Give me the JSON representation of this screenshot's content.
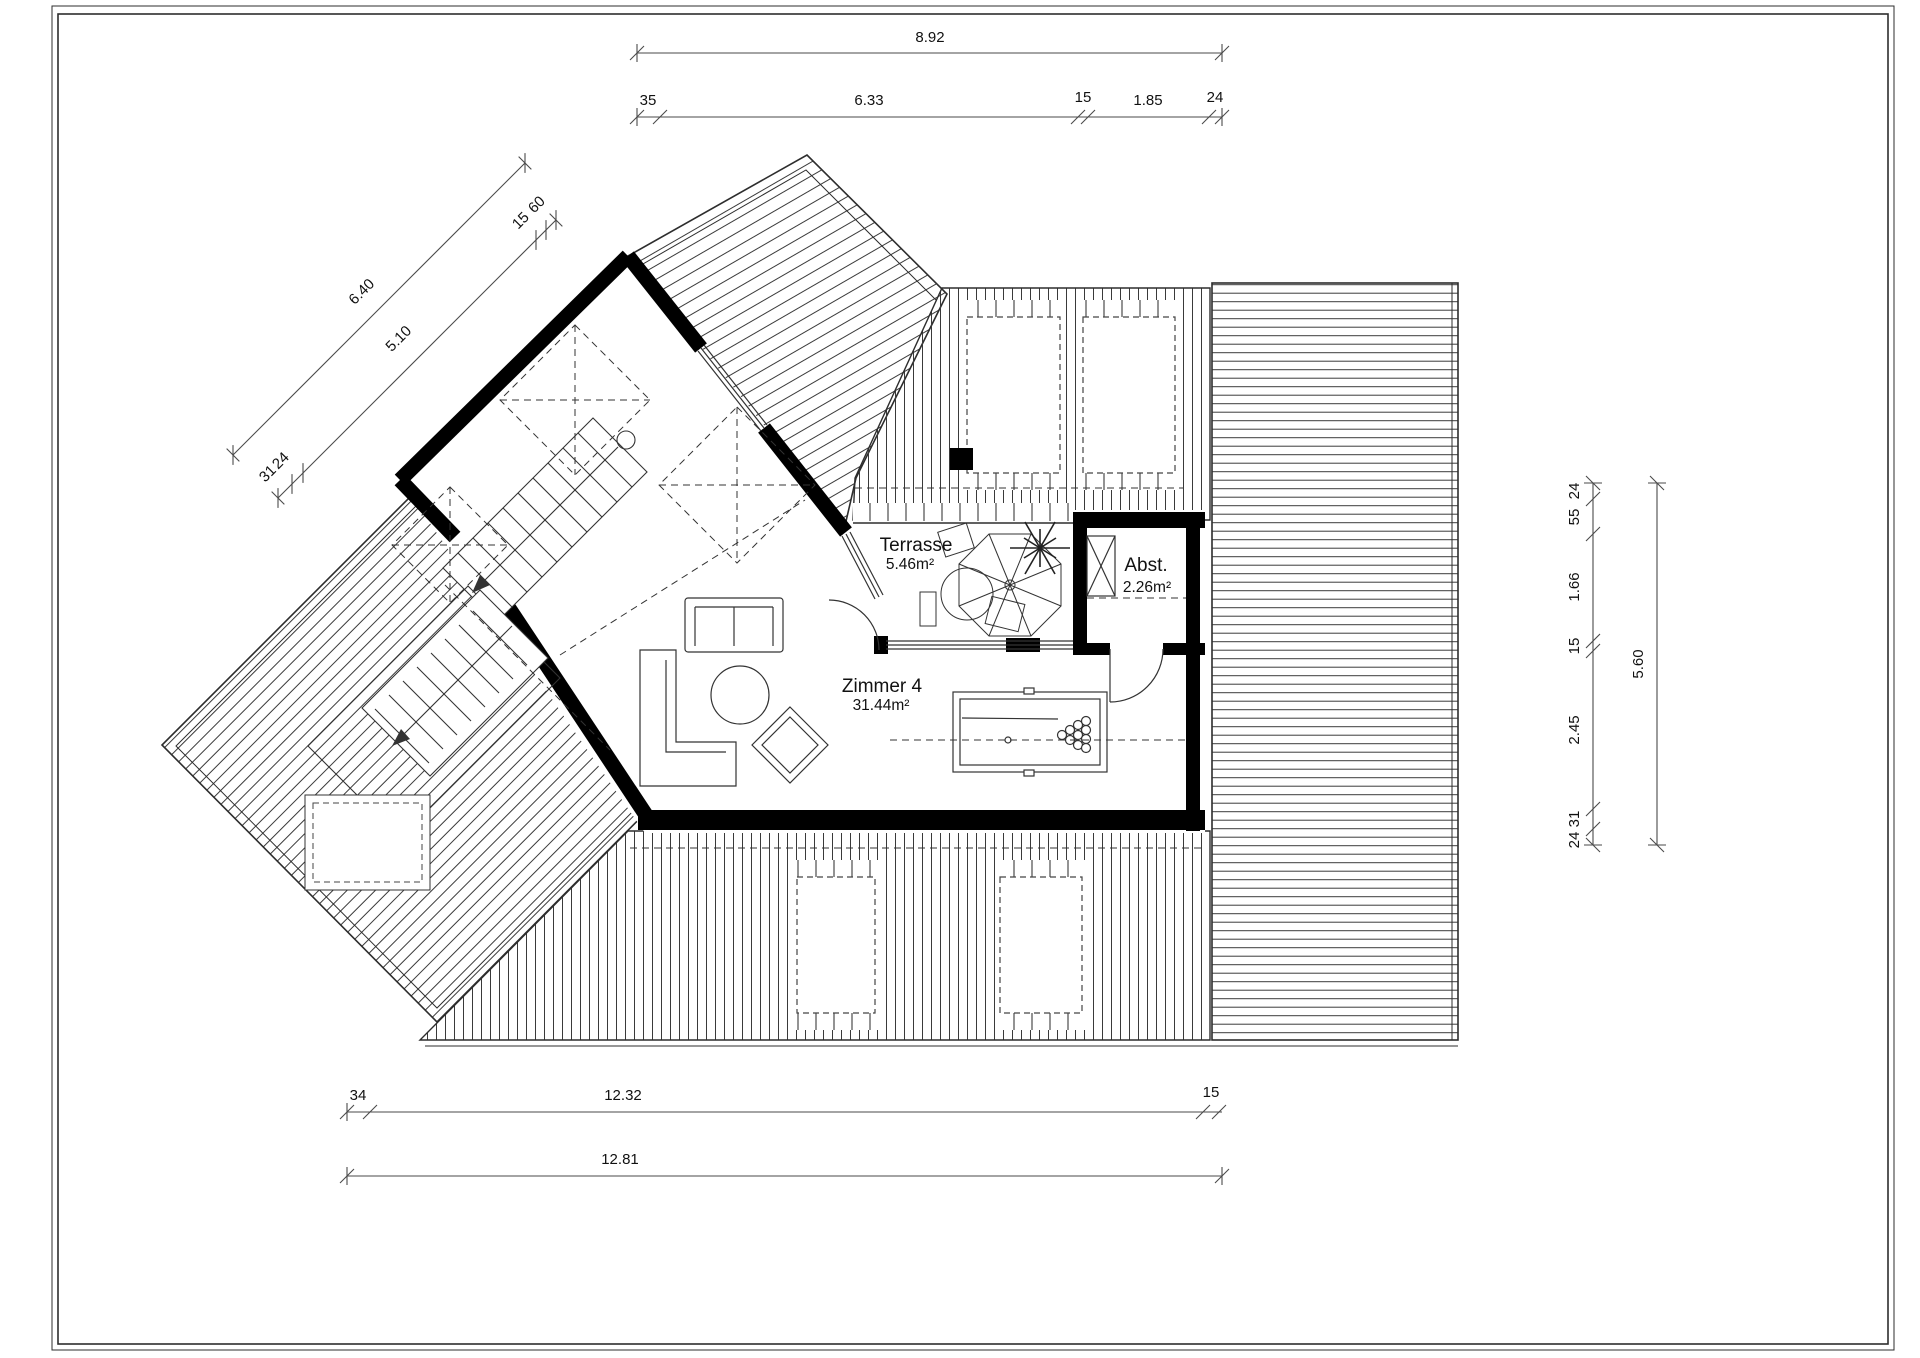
{
  "rooms": {
    "terrasse": {
      "name": "Terrasse",
      "area": "5.46m²"
    },
    "abstellraum": {
      "name": "Abst.",
      "area": "2.26m²"
    },
    "zimmer4": {
      "name": "Zimmer 4",
      "area": "31.44m²"
    }
  },
  "dimensions": {
    "top": {
      "total": "8.92",
      "seg": [
        "35",
        "6.33",
        "15",
        "1.85",
        "24"
      ]
    },
    "bottom": {
      "seg": [
        "34",
        "12.32",
        "15"
      ],
      "total": "12.81"
    },
    "left": {
      "total": "6.40",
      "main": "5.10",
      "small_low": [
        "31",
        "24"
      ],
      "small_high": [
        "15",
        "60"
      ]
    },
    "right": {
      "total": "5.60",
      "seg": [
        "24",
        "55",
        "1.66",
        "15",
        "2.45",
        "31",
        "24"
      ]
    }
  },
  "colors": {
    "wall": "#000000",
    "line": "#2d2d2d",
    "background": "#ffffff"
  }
}
